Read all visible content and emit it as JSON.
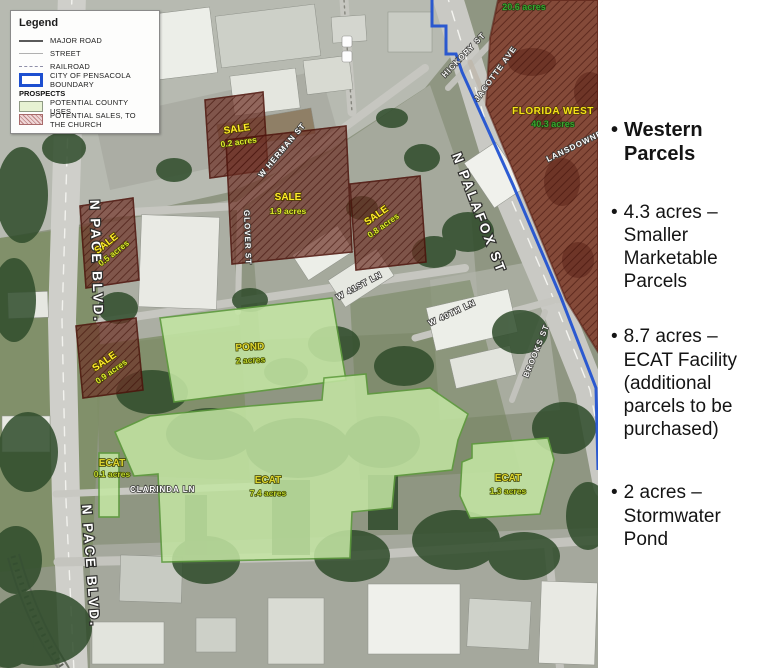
{
  "legend": {
    "title": "Legend",
    "line_items": [
      {
        "id": "major-road",
        "label": "MAJOR ROAD"
      },
      {
        "id": "street",
        "label": "STREET"
      },
      {
        "id": "railroad",
        "label": "RAILROAD"
      },
      {
        "id": "city-boundary",
        "label": "CITY OF PENSACOLA BOUNDARY"
      }
    ],
    "section_title": "PROSPECTS",
    "prospect_items": [
      {
        "id": "county-uses",
        "label": "POTENTIAL COUNTY USES",
        "color": "#e7f2d3"
      },
      {
        "id": "sales-church",
        "label": "POTENTIAL SALES, TO THE CHURCH",
        "color": "#bd8484"
      }
    ]
  },
  "sidebar": {
    "bullet_char": "•",
    "bullets": [
      {
        "text": "Western Parcels",
        "emphasis": "bold"
      },
      {
        "text": "4.3 acres – Smaller Marketable Parcels",
        "emphasis": "normal"
      },
      {
        "text": "8.7 acres – ECAT Facility (additional parcels to be purchased)",
        "emphasis": "normal"
      },
      {
        "text": "2 acres – Stormwater Pond",
        "emphasis": "normal"
      }
    ]
  },
  "map": {
    "streets": [
      {
        "id": "n-pace-blvd-north",
        "text": "N PACE BLVD."
      },
      {
        "id": "n-pace-blvd-south",
        "text": "N PACE BLVD."
      },
      {
        "id": "n-palafox-st",
        "text": "N PALAFOX ST"
      },
      {
        "id": "w-herman-st",
        "text": "W HERMAN ST"
      },
      {
        "id": "glover-st",
        "text": "GLOVER ST"
      },
      {
        "id": "w-41st-ln",
        "text": "W 41ST LN"
      },
      {
        "id": "w-40th-ln",
        "text": "W 40TH LN"
      },
      {
        "id": "clarinda-ln",
        "text": "CLARINDA LN"
      },
      {
        "id": "hickory-st",
        "text": "HICKORY ST"
      },
      {
        "id": "jacotte-ave",
        "text": "JACOTTE AVE"
      },
      {
        "id": "lansdowne-ave",
        "text": "LANSDOWNE AVE"
      },
      {
        "id": "brooks-st",
        "text": "BROOKS ST"
      }
    ],
    "parcels": {
      "sale": [
        {
          "name": "SALE",
          "acres": "0.2 acres"
        },
        {
          "name": "SALE",
          "acres": "0.5 acres"
        },
        {
          "name": "SALE",
          "acres": "0.9 acres"
        },
        {
          "name": "SALE",
          "acres": "1.9 acres"
        },
        {
          "name": "SALE",
          "acres": "0.8 acres"
        }
      ],
      "county": [
        {
          "name": "POND",
          "acres": "2 acres"
        },
        {
          "name": "ECAT",
          "acres": "7.4 acres"
        },
        {
          "name": "ECAT",
          "acres": "1.3 acres"
        },
        {
          "name": "ECAT",
          "acres": "0.1 acres"
        }
      ],
      "church": [
        {
          "name": "FLORIDA WEST",
          "acres": "40.3 acres"
        },
        {
          "name": "",
          "acres": "20.6 acres"
        }
      ]
    },
    "colors": {
      "boundary_blue": "#1d4fd0",
      "county_green_fill": "#c4e6a4",
      "county_green_border": "#5d9c3c",
      "church_parcel_red": "#6e3126",
      "sale_label_yellow": "#ffec2a",
      "acres_green": "#3da52f"
    }
  }
}
